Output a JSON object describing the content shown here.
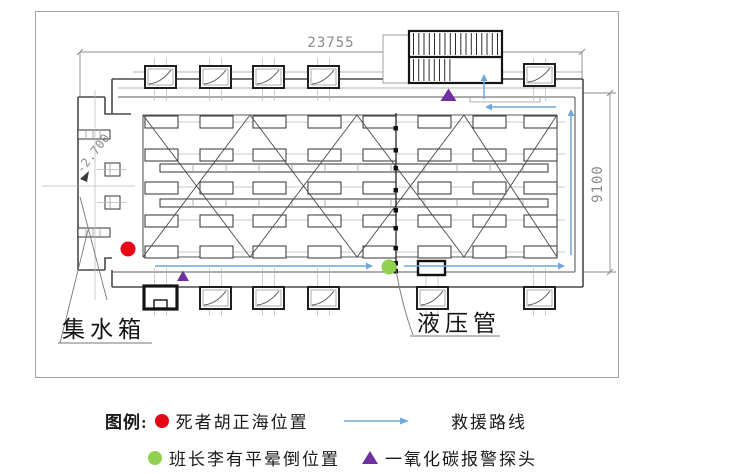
{
  "diagram": {
    "dimensions": {
      "top_width": "23755",
      "right_height": "9100",
      "left_elevation": "-2.700"
    },
    "labels": {
      "water_collection_tank": "集水箱",
      "hydraulic_pipe": "液压管"
    },
    "markers": {
      "deceased_position": {
        "shape": "circle",
        "color": "#e60613"
      },
      "foreman_fainted_position": {
        "shape": "circle",
        "color": "#92d050"
      },
      "co_alarm_probe": {
        "shape": "triangle",
        "color": "#7030a0"
      },
      "rescue_route": {
        "shape": "arrow-line",
        "color": "#6fa8dc"
      }
    }
  },
  "legend": {
    "title": "图例:",
    "items": [
      {
        "icon": "red-dot",
        "label": "死者胡正海位置"
      },
      {
        "icon": "rescue-route-arrow",
        "label": "救援路线"
      },
      {
        "icon": "green-dot",
        "label": "班长李有平晕倒位置"
      },
      {
        "icon": "purple-triangle",
        "label": "一氧化碳报警探头"
      }
    ]
  },
  "colors": {
    "red": "#e60613",
    "green": "#92d050",
    "purple": "#7030a0",
    "blue": "#6fa8dc",
    "line_dark": "#3f3f3f",
    "line_dim": "#8a8a8a"
  }
}
